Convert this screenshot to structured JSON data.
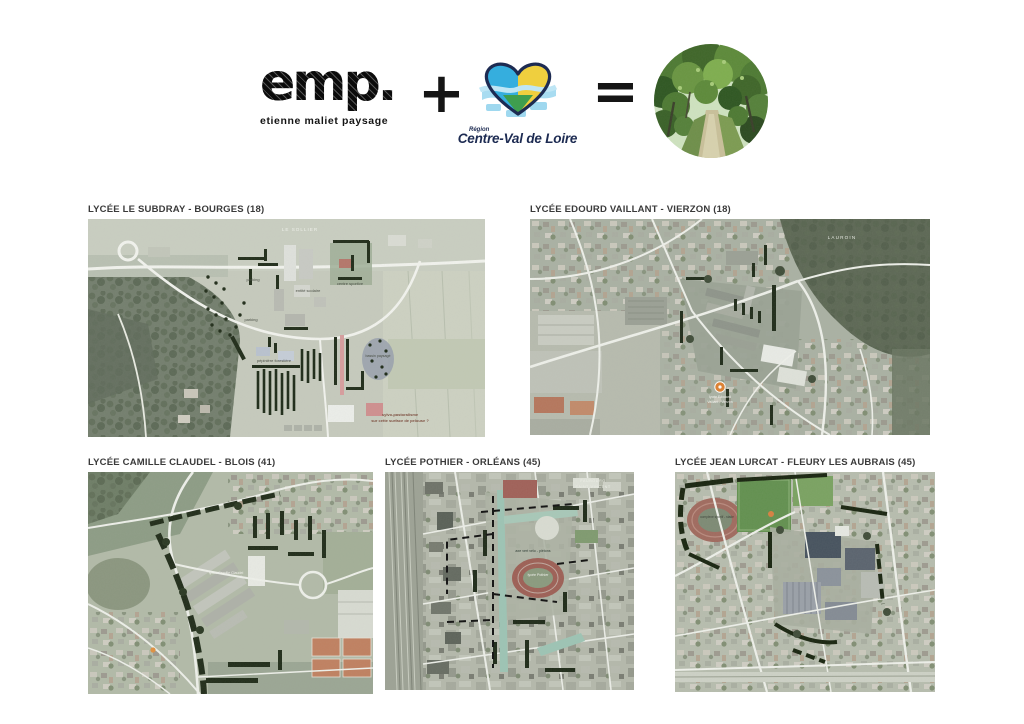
{
  "header": {
    "emp": {
      "wordmark": "emp.",
      "tagline": "etienne maliet paysage"
    },
    "plus_sign": "+",
    "region": {
      "small": "Région",
      "name": "Centre-Val de Loire"
    },
    "equals_sign": "=",
    "photo": "forest-path"
  },
  "colors": {
    "annotation_hedge": "#202c19",
    "region_blue": "#35aede",
    "region_yellow": "#efcf3e",
    "region_green": "#3f9e4e",
    "region_navy": "#1d2b52",
    "pin_orange": "#de8030"
  },
  "maps": [
    {
      "title": "LYCÉE LE SUBDRAY - BOURGES (18)",
      "labels": {
        "place": "LE SOLLIER",
        "parking_top": "parking",
        "school": "entité scolaire",
        "sport": "centre sportive",
        "parking_low": "parking",
        "nursery": "pépinière forestière",
        "basin": "bassin paysagé",
        "note_1": "sylvo-pastoralisme",
        "note_2": "sur cette surface de pelouse ?"
      }
    },
    {
      "title": "LYCÉE EDOURD VAILLANT - VIERZON (18)",
      "labels": {
        "place": "LAUROIN",
        "pin_1": "lycée Edouard",
        "pin_2": "Vaillant - Vierzon"
      }
    },
    {
      "title": "LYCÉE CAMILLE CLAUDEL - BLOIS (41)",
      "labels": {
        "school": "lycée Camille Claudel"
      }
    },
    {
      "title": "LYCÉE POTHIER - ORLÉANS (45)",
      "labels": {
        "place_1": "FAUBOURG",
        "place_2": "SAINT-VINCENT",
        "axis": "axe vert vélo - piétons",
        "school": "lycée Pothier"
      }
    },
    {
      "title": "LYCÉE JEAN LURCAT - FLEURY LES AUBRAIS (45)",
      "labels": {
        "stadium": "complexe sportif - stade"
      }
    }
  ]
}
